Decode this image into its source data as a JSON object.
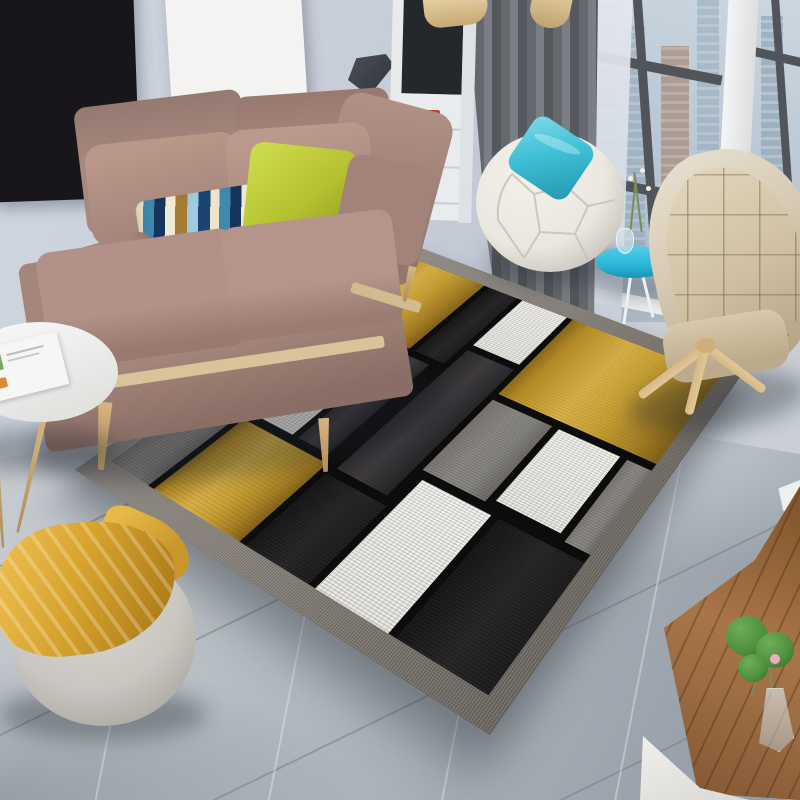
{
  "scene": {
    "label": "Modern living room with yellow, gray, black and white geometric patchwork area rug"
  },
  "posters": {
    "left": {
      "lines": [
        "LOVE",
        "WHAT",
        "YOU",
        "DO"
      ]
    },
    "right": {
      "lines": [
        "DO",
        "WHAT",
        "YOU",
        "LOVE"
      ]
    }
  },
  "palette": {
    "wall": "#c6cdd8",
    "floor-light": "#c8cdd2",
    "floor-mid": "#b2b9c0",
    "floor-dark": "#9099a2",
    "rug-border": "#8d8780",
    "rug-line": "#0d0c0c",
    "rug-yellow": "#c7a134",
    "rug-white": "#f4f3ef",
    "rug-gray": "#8d8984",
    "rug-charcoal": "#3a373a",
    "rug-black": "#1a191a",
    "sofa": "#a5867d",
    "sofa-light": "#b69589",
    "sofa-dark": "#8d7168",
    "sofa-wood": "#d8c39a",
    "pillow-green": "#b4c02f",
    "pillow-cyan": "#3fc0d6",
    "stripe-navy": "#16355c",
    "stripe-blue": "#3f88ae",
    "stripe-sky": "#9ecbdd",
    "stripe-tan": "#a67c34",
    "stripe-cream": "#ece5cc",
    "beanbag": "#eae7df",
    "table-blue": "#29b6d8",
    "chair-shell": "#e7dfcf",
    "chair-quilt": "#cfc0a2",
    "wood-leg": "#d5b888",
    "curtain": "#65686d",
    "window-frame": "#4f555b",
    "glazing": "#b8c5d1",
    "building-brick": "#a98d7e",
    "building-blue": "#93a9ba",
    "poster-dark": "#18161a",
    "poster-text-light": "#efece6",
    "poster-light": "#f4f3f1",
    "poster-text-dark": "#1a1a1a",
    "smudge-blue": "#3a6ea8",
    "shelf-dark": "#24272b",
    "toy-red": "#c23a2c",
    "gold": "#b8923a",
    "lamp": "#3b3e43",
    "pouf": "#c9c5c0",
    "throw": "#d7a32e",
    "wood": "#9a6b42",
    "plant": "#4e8f3c",
    "plant-pink": "#e9aec4"
  },
  "rug": {
    "cells": [
      {
        "x": 24,
        "y": 24,
        "w": 172,
        "h": 140,
        "c": "y"
      },
      {
        "x": 206,
        "y": 24,
        "w": 52,
        "h": 140,
        "c": "k"
      },
      {
        "x": 268,
        "y": 24,
        "w": 80,
        "h": 98,
        "c": "w"
      },
      {
        "x": 358,
        "y": 24,
        "w": 238,
        "h": 148,
        "c": "y"
      },
      {
        "x": 24,
        "y": 174,
        "w": 156,
        "h": 154,
        "c": "w"
      },
      {
        "x": 190,
        "y": 174,
        "w": 52,
        "h": 154,
        "c": "c"
      },
      {
        "x": 268,
        "y": 132,
        "w": 80,
        "h": 206,
        "c": "c"
      },
      {
        "x": 358,
        "y": 182,
        "w": 94,
        "h": 114,
        "c": "g"
      },
      {
        "x": 462,
        "y": 182,
        "w": 90,
        "h": 108,
        "c": "w"
      },
      {
        "x": 562,
        "y": 182,
        "w": 34,
        "h": 114,
        "c": "g"
      },
      {
        "x": 24,
        "y": 338,
        "w": 72,
        "h": 108,
        "c": "g"
      },
      {
        "x": 106,
        "y": 338,
        "w": 146,
        "h": 108,
        "c": "y"
      },
      {
        "x": 262,
        "y": 348,
        "w": 96,
        "h": 98,
        "c": "k"
      },
      {
        "x": 368,
        "y": 306,
        "w": 102,
        "h": 140,
        "c": "w"
      },
      {
        "x": 480,
        "y": 306,
        "w": 116,
        "h": 140,
        "c": "k"
      }
    ]
  }
}
